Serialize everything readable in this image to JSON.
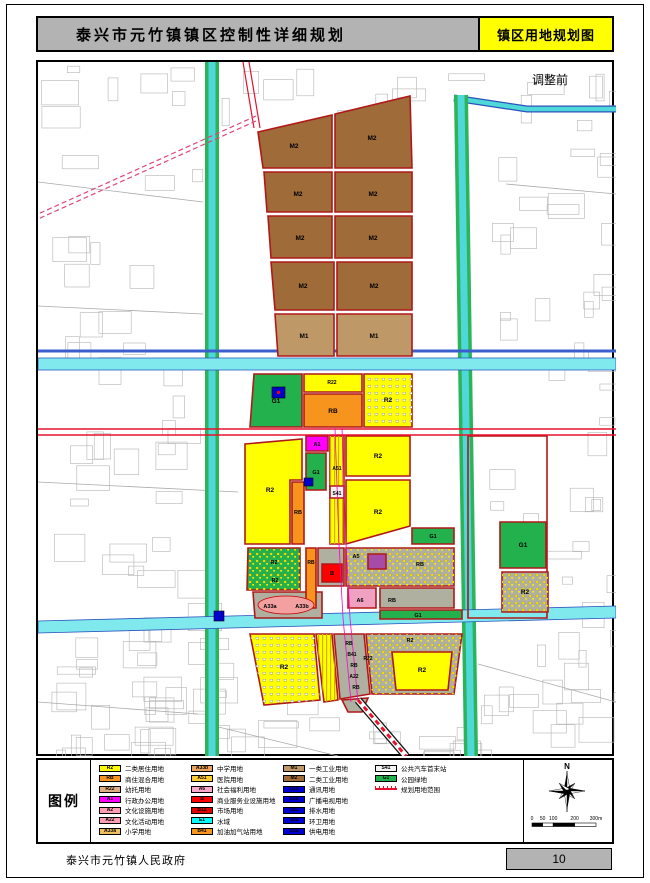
{
  "header": {
    "plan_title": "泰兴市元竹镇镇区控制性详细规划",
    "map_title": "镇区用地规划图"
  },
  "map": {
    "annotation": "调整前",
    "north_label": "N",
    "scale_ticks": [
      "0",
      "50",
      "100",
      "200",
      "300m"
    ],
    "layers_under": [
      {
        "t": "poly",
        "p": "167,0 181,0 181,694 167,694",
        "f": "#2db35a"
      },
      {
        "t": "poly",
        "p": "170.5,0 177.5,0 177.5,694 170.5,694",
        "f": "#4fd8d8"
      },
      {
        "t": "line",
        "p": "416,36 489,47 578,47",
        "s": "#2a52be",
        "w": 7
      },
      {
        "t": "line",
        "p": "416,36 489,47 578,47",
        "s": "#4fd8d8",
        "w": 4.5
      },
      {
        "t": "poly",
        "p": "416,33 430,33 440,694 426,694",
        "f": "#2db35a"
      },
      {
        "t": "poly",
        "p": "419.5,33 426.5,33 436.5,694 429.5,694",
        "f": "#4fd8d8"
      },
      {
        "t": "line",
        "p": "0,289 578,289",
        "s": "#3a5fcd",
        "w": 3
      },
      {
        "t": "poly",
        "p": "0,296 578,296 578,308 0,308",
        "f": "#7fe9ee",
        "s": "#2a52be",
        "w": 0.8
      },
      {
        "t": "poly",
        "p": "0,559 578,544 578,556 0,571",
        "f": "#7fe9ee",
        "s": "#2a52be",
        "w": 0.8
      }
    ],
    "parcels": [
      {
        "p": "220,70 294,53 294,106 225,106",
        "f": "#9e6b39"
      },
      {
        "p": "297,52 372,34 374,106 297,106",
        "f": "#9e6b39"
      },
      {
        "p": "226,110 294,110 294,150 229,150",
        "f": "#9e6b39"
      },
      {
        "p": "297,110 374,110 374,150 297,150",
        "f": "#9e6b39"
      },
      {
        "p": "230,154 294,154 294,196 233,196",
        "f": "#9e6b39"
      },
      {
        "p": "297,154 374,154 374,196 297,196",
        "f": "#9e6b39"
      },
      {
        "p": "233,200 296,200 296,248 237,248",
        "f": "#9e6b39"
      },
      {
        "p": "299,200 374,200 374,248 299,248",
        "f": "#9e6b39"
      },
      {
        "p": "237,252 296,252 296,294 240,294",
        "f": "#bf9868"
      },
      {
        "p": "299,252 374,252 374,294 299,294",
        "f": "#bf9868"
      },
      {
        "p": "216,312 264,312 264,365 212,365",
        "f": "#22b14c"
      },
      {
        "p": "266,312 324,312 324,330 266,330",
        "f": "#ffff00"
      },
      {
        "p": "266,332 324,332 324,365 266,365",
        "f": "#f7941d"
      },
      {
        "p": "326,312 374,312 374,365 326,365",
        "f": "#ffff00",
        "pat": "sp2"
      },
      {
        "p": "207,382 264,377 264,418 252,418 252,482 207,482",
        "f": "#ffff00"
      },
      {
        "p": "254,420 266,420 266,482 254,482",
        "f": "#f7941d"
      },
      {
        "p": "268,374 290,374 290,389 268,389",
        "f": "#ff00ff"
      },
      {
        "p": "268,391 288,391 288,428 268,428",
        "f": "#22b14c"
      },
      {
        "p": "292,374 306,374 306,482 292,482",
        "f": "#ffff00",
        "pat": "ha"
      },
      {
        "p": "292,424 306,424 306,436 292,436",
        "f": "#f2f2f2"
      },
      {
        "p": "308,374 372,374 372,414 308,414",
        "f": "#ffff00"
      },
      {
        "p": "308,418 372,418 372,464 308,482",
        "f": "#ffff00"
      },
      {
        "p": "374,466 416,466 416,482 374,482",
        "f": "#22b14c"
      },
      {
        "p": "430,374 509,374 509,556 430,556",
        "f": "none"
      },
      {
        "p": "462,460 508,460 508,506 462,506",
        "f": "#22b14c"
      },
      {
        "p": "464,510 510,510 510,550 464,550",
        "f": "#b0b0a0",
        "pat": "sp"
      },
      {
        "p": "210,486 262,486 262,528 209,528",
        "f": "#22b14c",
        "pat": "sp"
      },
      {
        "p": "215,530 284,530 284,556 217,556",
        "f": "#b0b0a0"
      },
      {
        "p": "268,486 278,486 278,546 268,546",
        "f": "#f7941d"
      },
      {
        "p": "280,486 306,486 306,524 280,524",
        "f": "#b0b0a0"
      },
      {
        "p": "284,502 304,502 304,520 284,520",
        "f": "#ff0000"
      },
      {
        "p": "308,486 416,486 416,524 308,524",
        "f": "#b0b0a0",
        "pat": "sp"
      },
      {
        "p": "330,492 348,492 348,507 330,507",
        "f": "#a64ca6"
      },
      {
        "p": "310,526 338,526 338,546 310,546",
        "f": "#f0a0c0"
      },
      {
        "p": "342,526 416,526 416,546 342,546",
        "f": "#b0b0a0"
      },
      {
        "p": "342,548 424,548 424,557 342,557",
        "f": "#22b14c"
      },
      {
        "p": "212,572 276,572 282,638 226,643",
        "f": "#ffff00",
        "pat": "sp2"
      },
      {
        "p": "278,572 294,572 300,638 286,640",
        "f": "#ffff00",
        "pat": "ha"
      },
      {
        "p": "296,572 326,572 332,632 302,637",
        "f": "#b0b0a0"
      },
      {
        "p": "328,572 424,572 416,632 334,632",
        "f": "#b0b0a0",
        "pat": "sp"
      },
      {
        "p": "354,590 414,590 410,628 358,628",
        "f": "#ffff00"
      },
      {
        "p": "304,638 330,636 324,650 310,650",
        "f": "#b0b0a0"
      }
    ],
    "layers_over": [
      {
        "t": "line",
        "p": "0,367 578,367",
        "s": "#e8112d",
        "w": 1.4
      },
      {
        "t": "line",
        "p": "0,373 578,373",
        "s": "#e8112d",
        "w": 1.4
      },
      {
        "t": "line",
        "p": "205,0 216,66",
        "s": "#e8112d",
        "w": 1.2
      },
      {
        "t": "line",
        "p": "211,0 222,66",
        "s": "#e8112d",
        "w": 1.2
      },
      {
        "t": "line",
        "p": "218,54 0,152",
        "s": "#e0457b",
        "w": 1.2,
        "dash": "5,3"
      },
      {
        "t": "line",
        "p": "218,59 0,157",
        "s": "#e0457b",
        "w": 1.2,
        "dash": "5,3"
      },
      {
        "t": "line",
        "p": "297,366 301,482 305,556 313,640",
        "s": "#ff00cc",
        "w": 0.8
      },
      {
        "t": "line",
        "p": "304,366 308,482 312,556 320,640",
        "s": "#ff00cc",
        "w": 0.8
      },
      {
        "t": "line",
        "p": "320,638 368,694",
        "s": "#111111",
        "w": 8
      },
      {
        "t": "line",
        "p": "320,638 368,694",
        "s": "#ffffff",
        "w": 5.5
      },
      {
        "t": "line",
        "p": "320,638 368,694",
        "s": "#e8112d",
        "w": 3,
        "dash": "5,4"
      },
      {
        "t": "ellipse",
        "cx": 248,
        "cy": 543,
        "rx": 28,
        "ry": 9,
        "f": "#f2a0a0",
        "s": "#c00000",
        "w": 0.8
      }
    ],
    "utility_squares": [
      {
        "x": 234,
        "y": 325,
        "w": 13,
        "h": 11,
        "dot": true
      },
      {
        "x": 266,
        "y": 416,
        "w": 9,
        "h": 8
      },
      {
        "x": 176,
        "y": 549,
        "w": 10,
        "h": 10
      }
    ],
    "labels": [
      {
        "t": "M2",
        "x": 256,
        "y": 86
      },
      {
        "t": "M2",
        "x": 334,
        "y": 78
      },
      {
        "t": "M2",
        "x": 260,
        "y": 134
      },
      {
        "t": "M2",
        "x": 335,
        "y": 134
      },
      {
        "t": "M2",
        "x": 262,
        "y": 178
      },
      {
        "t": "M2",
        "x": 335,
        "y": 178
      },
      {
        "t": "M2",
        "x": 265,
        "y": 226
      },
      {
        "t": "M2",
        "x": 336,
        "y": 226
      },
      {
        "t": "M1",
        "x": 266,
        "y": 276
      },
      {
        "t": "M1",
        "x": 336,
        "y": 276
      },
      {
        "t": "G1",
        "x": 238,
        "y": 341
      },
      {
        "t": "R22",
        "x": 294,
        "y": 322,
        "s": 5
      },
      {
        "t": "RB",
        "x": 295,
        "y": 351
      },
      {
        "t": "R2",
        "x": 350,
        "y": 340
      },
      {
        "t": "R2",
        "x": 232,
        "y": 430
      },
      {
        "t": "A1",
        "x": 279,
        "y": 384,
        "s": 5.5
      },
      {
        "t": "G1",
        "x": 278,
        "y": 412,
        "s": 5.5
      },
      {
        "t": "A51",
        "x": 299,
        "y": 408,
        "s": 5
      },
      {
        "t": "S41",
        "x": 299,
        "y": 433,
        "s": 5
      },
      {
        "t": "RB",
        "x": 260,
        "y": 452,
        "s": 5.5
      },
      {
        "t": "R2",
        "x": 340,
        "y": 396
      },
      {
        "t": "R2",
        "x": 340,
        "y": 452
      },
      {
        "t": "G1",
        "x": 395,
        "y": 476,
        "s": 5.5
      },
      {
        "t": "G1",
        "x": 485,
        "y": 485
      },
      {
        "t": "R2",
        "x": 487,
        "y": 532
      },
      {
        "t": "R2",
        "x": 236,
        "y": 502,
        "s": 5.5
      },
      {
        "t": "R2",
        "x": 237,
        "y": 520,
        "s": 5.5
      },
      {
        "t": "A33a",
        "x": 232,
        "y": 546,
        "s": 5.5
      },
      {
        "t": "A33b",
        "x": 264,
        "y": 546,
        "s": 5.5
      },
      {
        "t": "RB",
        "x": 273,
        "y": 502,
        "s": 5
      },
      {
        "t": "B",
        "x": 294,
        "y": 513,
        "s": 5.5
      },
      {
        "t": "A5",
        "x": 318,
        "y": 496,
        "s": 5.5
      },
      {
        "t": "A6",
        "x": 322,
        "y": 540,
        "s": 5.5
      },
      {
        "t": "RB",
        "x": 354,
        "y": 540,
        "s": 5.5
      },
      {
        "t": "RB",
        "x": 382,
        "y": 504,
        "s": 5.5
      },
      {
        "t": "G1",
        "x": 380,
        "y": 555,
        "s": 5.5
      },
      {
        "t": "R2",
        "x": 246,
        "y": 607
      },
      {
        "t": "RB",
        "x": 311,
        "y": 583,
        "s": 5
      },
      {
        "t": "B41",
        "x": 314,
        "y": 594,
        "s": 5
      },
      {
        "t": "R22",
        "x": 330,
        "y": 598,
        "s": 5
      },
      {
        "t": "RB",
        "x": 316,
        "y": 605,
        "s": 5
      },
      {
        "t": "A22",
        "x": 316,
        "y": 616,
        "s": 5
      },
      {
        "t": "RB",
        "x": 318,
        "y": 627,
        "s": 5
      },
      {
        "t": "R2",
        "x": 372,
        "y": 580,
        "s": 5.5
      },
      {
        "t": "R2",
        "x": 384,
        "y": 610
      }
    ]
  },
  "legend": {
    "title": "图例",
    "columns": [
      [
        {
          "code": "R2",
          "color": "#ffff00",
          "label": "二类居住用地"
        },
        {
          "code": "RB",
          "color": "#f7941d",
          "label": "商住混合用地"
        },
        {
          "code": "R22",
          "color": "#e0b080",
          "label": "幼托用地"
        },
        {
          "code": "A1",
          "color": "#ff00ff",
          "label": "行政办公用地"
        },
        {
          "code": "A2",
          "color": "#ff9eb5",
          "label": "文化设施用地"
        },
        {
          "code": "A22",
          "color": "#ff9eb5",
          "label": "文化活动用地"
        },
        {
          "code": "A33a",
          "color": "#f0c060",
          "label": "小学用地"
        }
      ],
      [
        {
          "code": "A33b",
          "color": "#eba45e",
          "label": "中学用地"
        },
        {
          "code": "A51",
          "color": "#ffcc33",
          "label": "医院用地"
        },
        {
          "code": "A6",
          "color": "#ffaacc",
          "label": "社会福利用地"
        },
        {
          "code": "B",
          "color": "#ff0000",
          "label": "商业服务业设施用地"
        },
        {
          "code": "B12",
          "color": "#e00000",
          "label": "市场用地"
        },
        {
          "code": "E1",
          "color": "#00ffff",
          "label": "水域"
        },
        {
          "code": "B41",
          "color": "#f7941d",
          "label": "加油加气站用地"
        }
      ],
      [
        {
          "code": "M1",
          "color": "#bf9868",
          "label": "一类工业用地"
        },
        {
          "code": "M2",
          "color": "#9e6b39",
          "label": "二类工业用地"
        },
        {
          "code": "U15",
          "color": "#0000d0",
          "label": "通讯用地"
        },
        {
          "code": "U16",
          "color": "#0000d0",
          "label": "广播电视用地"
        },
        {
          "code": "U21",
          "color": "#0000d0",
          "label": "排水用地"
        },
        {
          "code": "U22",
          "color": "#0000d0",
          "label": "环卫用地"
        },
        {
          "code": "U12",
          "color": "#0000d0",
          "label": "供电用地"
        }
      ],
      [
        {
          "code": "S41",
          "color": "#f5f5f5",
          "label": "公共汽车首末站"
        },
        {
          "code": "G1",
          "color": "#22b14c",
          "label": "公园绿地"
        },
        {
          "swatch": "line",
          "code": "",
          "color": "#ffffff",
          "label": "规划用地范围"
        }
      ]
    ]
  },
  "footer": {
    "org": "泰兴市元竹镇人民政府",
    "page": "10"
  }
}
